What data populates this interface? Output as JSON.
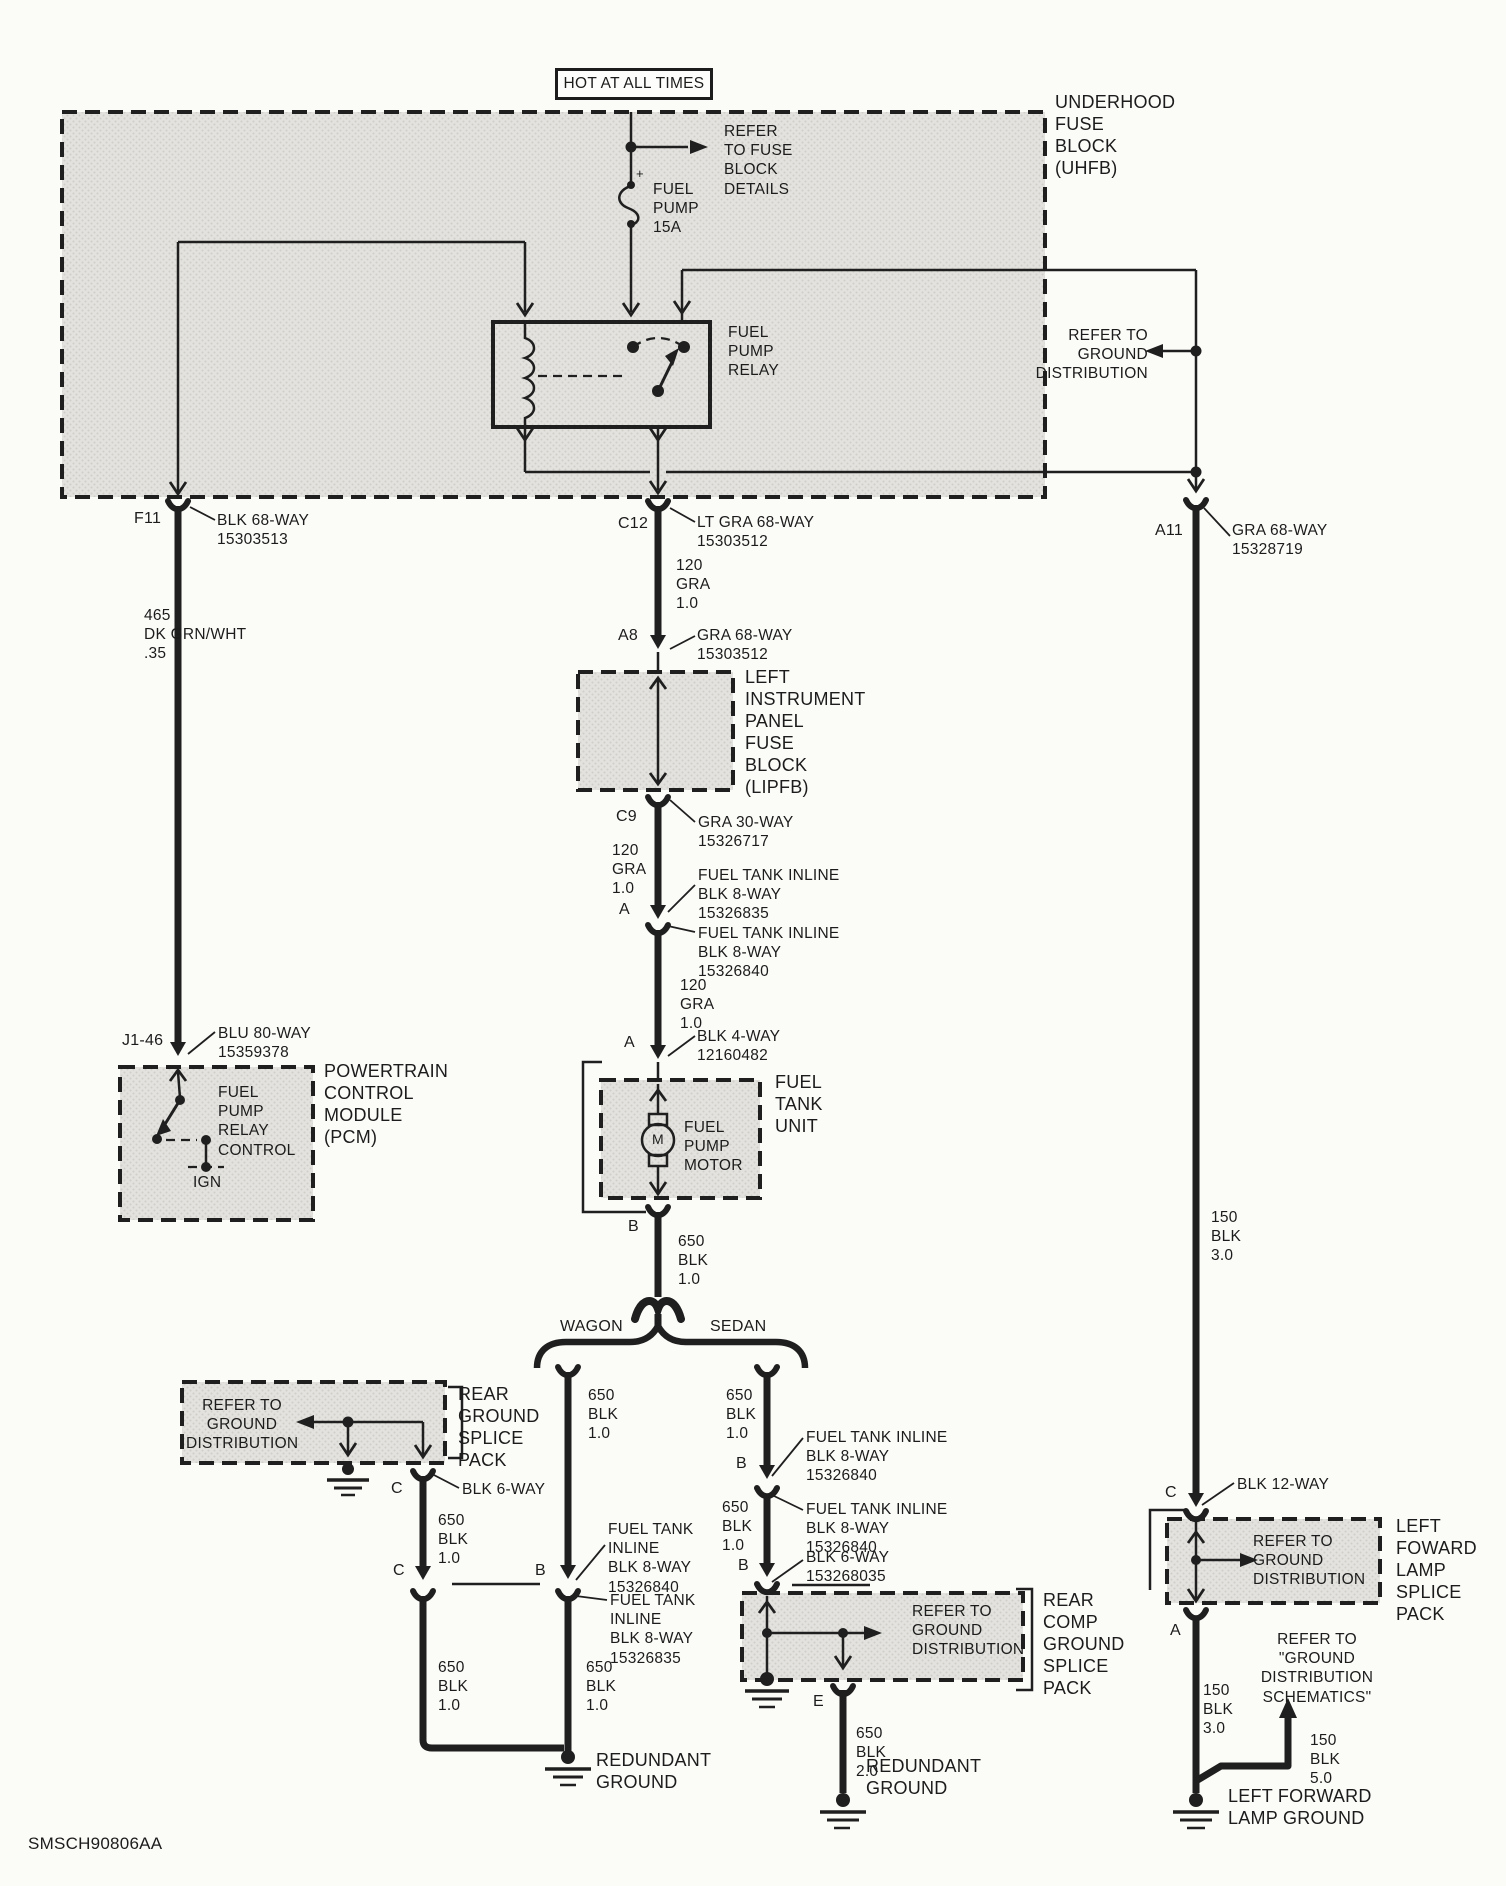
{
  "palette": {
    "line": "#1f1f1f",
    "paper": "#fbfbf8",
    "block_fill": "#e3e2de"
  },
  "doc_id": "SMSCH90806AA",
  "banner": {
    "hot": "HOT AT ALL TIMES"
  },
  "uhfb": {
    "label": "UNDERHOOD\nFUSE\nBLOCK\n(UHFB)",
    "refer_fuse": "REFER\nTO FUSE\nBLOCK\nDETAILS",
    "fuse_plus": "+",
    "fuse": "FUEL\nPUMP\n15A",
    "relay": "FUEL\nPUMP\nRELAY",
    "refer_ground": "REFER TO\nGROUND\nDISTRIBUTION"
  },
  "pcm_branch": {
    "f11": "F11",
    "f11_conn": "BLK 68-WAY\n15303513",
    "wire": "465\nDK GRN/WHT\n.35",
    "j146": "J1-46",
    "j146_conn": "BLU 80-WAY\n15359378",
    "pcm_internal": "FUEL\nPUMP\nRELAY\nCONTROL",
    "ign": "IGN",
    "pcm_label": "POWERTRAIN\nCONTROL\nMODULE\n(PCM)"
  },
  "center": {
    "c12": "C12",
    "c12_conn": "LT GRA 68-WAY\n15303512",
    "wire1": "120\nGRA\n1.0",
    "a8": "A8",
    "a8_conn": "GRA 68-WAY\n15303512",
    "lipfb_label": "LEFT\nINSTRUMENT\nPANEL\nFUSE\nBLOCK\n(LIPFB)",
    "c9": "C9",
    "c9_conn": "GRA 30-WAY\n15326717",
    "wire2": "120\nGRA\n1.0",
    "a1": "A",
    "conn_835": "FUEL TANK INLINE\nBLK 8-WAY\n15326835",
    "conn_840": "FUEL TANK INLINE\nBLK 8-WAY\n15326840",
    "wire3": "120\nGRA\n1.0",
    "a2": "A",
    "conn_4way": "BLK 4-WAY\n12160482",
    "ftu_label": "FUEL\nTANK\nUNIT",
    "motor_label": "FUEL\nPUMP\nMOTOR",
    "motor_m": "M",
    "b": "B",
    "wire4": "650\nBLK\n1.0",
    "wagon": "WAGON",
    "sedan": "SEDAN"
  },
  "wagon_branch": {
    "wire_top": "650\nBLK\n1.0",
    "rgsp_refer": "REFER TO\nGROUND\nDISTRIBUTION",
    "rgsp_label": "REAR\nGROUND\nSPLICE\nPACK",
    "c1": "C",
    "conn_6way": "BLK 6-WAY",
    "wire2": "650\nBLK\n1.0",
    "c2": "C",
    "b": "B",
    "conn_840": "FUEL TANK\nINLINE\nBLK 8-WAY\n15326840",
    "conn_835": "FUEL TANK\nINLINE\nBLK 8-WAY\n15326835",
    "wire3a": "650\nBLK\n1.0",
    "wire3b": "650\nBLK\n1.0",
    "ground": "REDUNDANT\nGROUND"
  },
  "sedan_branch": {
    "wire_top": "650\nBLK\n1.0",
    "b1": "B",
    "conn_840a": "FUEL TANK INLINE\nBLK 8-WAY\n15326840",
    "wire2": "650\nBLK\n1.0",
    "conn_840b": "FUEL TANK INLINE\nBLK 8-WAY\n15326840",
    "b2": "B",
    "conn_6way": "BLK 6-WAY\n153268035",
    "rcgsp_refer": "REFER TO\nGROUND\nDISTRIBUTION",
    "rcgsp_label": "REAR\nCOMP\nGROUND\nSPLICE\nPACK",
    "e": "E",
    "wire3": "650\nBLK\n2.0",
    "ground": "REDUNDANT\nGROUND"
  },
  "right_branch": {
    "a11": "A11",
    "a11_conn": "GRA 68-WAY\n15328719",
    "wire1": "150\nBLK\n3.0",
    "c": "C",
    "conn_12way": "BLK 12-WAY",
    "lflsp_refer": "REFER TO\nGROUND\nDISTRIBUTION",
    "lflsp_label": "LEFT\nFOWARD\nLAMP\nSPLICE\nPACK",
    "a": "A",
    "wire2": "150\nBLK\n3.0",
    "refer_schematics": "REFER TO\n\"GROUND\nDISTRIBUTION\nSCHEMATICS\"",
    "wire3": "150\nBLK\n5.0",
    "ground": "LEFT FORWARD\nLAMP GROUND"
  }
}
